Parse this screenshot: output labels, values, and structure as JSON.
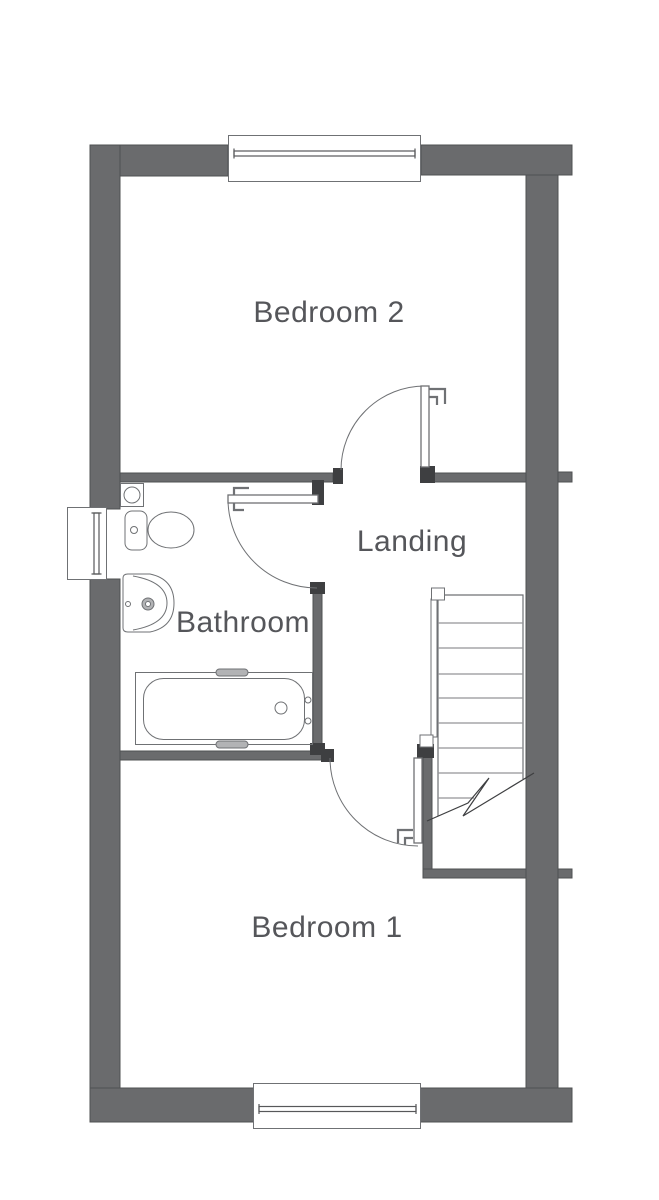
{
  "rooms": {
    "bedroom2": {
      "label": "Bedroom 2"
    },
    "landing": {
      "label": "Landing"
    },
    "bathroom": {
      "label": "Bathroom"
    },
    "bedroom1": {
      "label": "Bedroom 1"
    }
  },
  "fixtures": {
    "toilet": "toilet",
    "washbasin": "washbasin-pedestal",
    "bathtub": "bathtub",
    "boiler": "wall-unit-with-extractor",
    "staircase": "staircase-with-break-line",
    "windows": [
      "window-top",
      "window-left",
      "window-bottom"
    ],
    "doors": [
      "door-bedroom2",
      "door-bathroom",
      "door-bedroom1"
    ]
  },
  "colors": {
    "background": "#ffffff",
    "wall_fill": "#6a6b6d",
    "wall_outline": "#4f5052",
    "wall_cap": "#3e3f41",
    "line": "#6f7174",
    "line_light": "#949597",
    "glazing": "#57585a",
    "text": "#55565a"
  }
}
